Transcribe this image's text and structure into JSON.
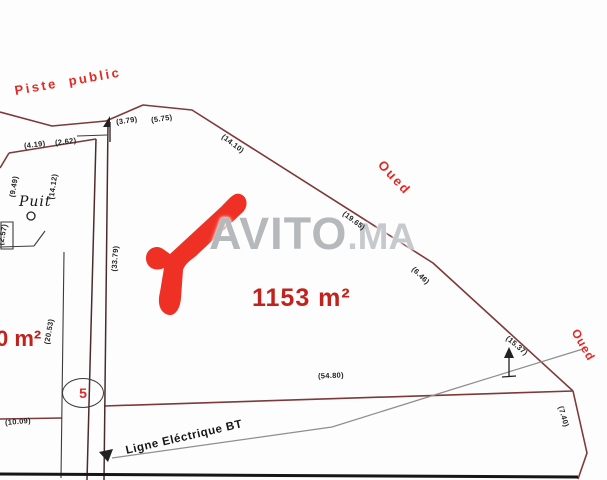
{
  "plan": {
    "road_label": "Piste public",
    "river_label_top": "Oued",
    "river_label_right": "Oued",
    "well_label": "Puit",
    "power_line_label": "Ligne Eléctrique BT",
    "area_main": "1153 m²",
    "area_left_partial": "0 m²",
    "road_number": "5",
    "dimensions": [
      "(4.19)",
      "(2.62)",
      "(3.79)",
      "(5.75)",
      "(14.10)",
      "(19.65)",
      "(6.46)",
      "(15.37)",
      "(54.80)",
      "(7.40)",
      "(10.09)",
      "(9.49)",
      "(14.12)",
      "(2.57)",
      "(20.53)",
      "(33.79)"
    ]
  },
  "watermark": {
    "brand": "AVITO",
    "suffix": ".MA"
  },
  "colors": {
    "boundary": "#7d3a3a",
    "accent_red": "#e02a25",
    "dark_red_text": "#c1221b",
    "watermark_gray": "#b6b9bc",
    "logo_red": "#ee3124"
  }
}
